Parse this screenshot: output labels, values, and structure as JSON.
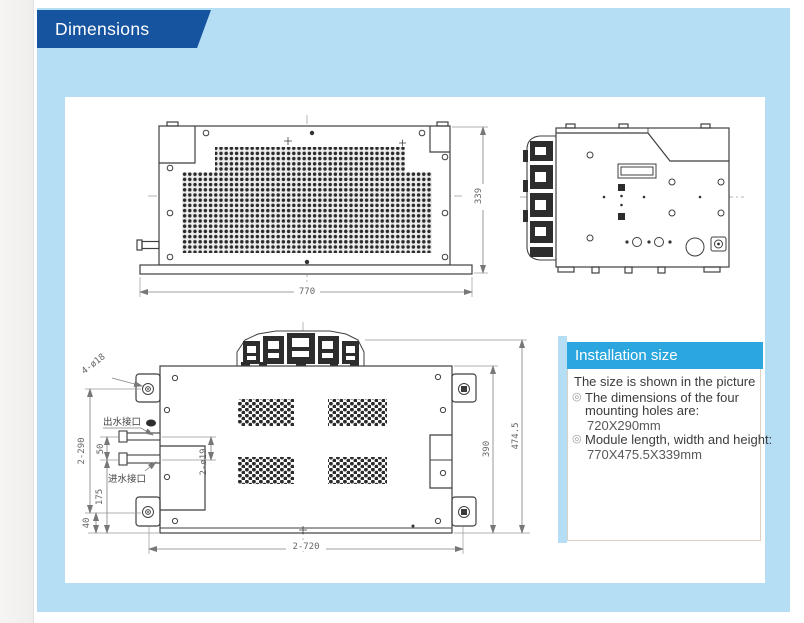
{
  "page": {
    "title": "Dimensions"
  },
  "installation_panel": {
    "header": "Installation size",
    "intro": "The size is shown in the picture",
    "bullets": [
      {
        "label": "The dimensions of the four mounting holes are:",
        "value": "720X290mm"
      },
      {
        "label": "Module length, width and height:",
        "value": "770X475.5X339mm"
      }
    ]
  },
  "front_view": {
    "dim_width": "770",
    "dim_height": "339"
  },
  "top_view": {
    "dim_mounting_holes": "4-ø18",
    "label_water_outlet": "出水接口",
    "label_water_inlet": "进水接口",
    "dim_pipe_diameter": "2-ø19",
    "dim_hole_spacing_vertical": "2-290",
    "dim_pipe_spacing": "50",
    "dim_inlet_offset": "175",
    "dim_hole_bottom_offset": "40",
    "dim_hole_spacing_horizontal": "2-720",
    "dim_body_depth": "390",
    "dim_total_depth": "474.5"
  },
  "colors": {
    "panel_blue": "#b5def4",
    "ribbon_blue": "#17549f",
    "header_cyan": "#2ba6de"
  }
}
